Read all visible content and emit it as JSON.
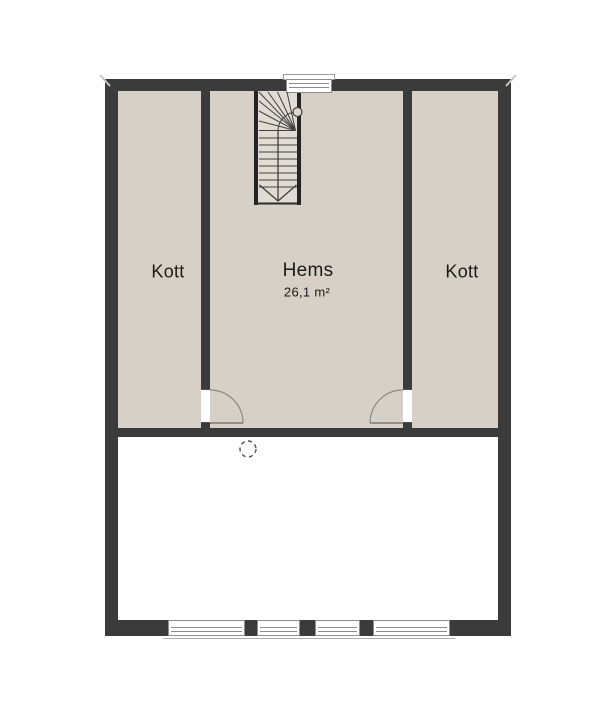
{
  "rooms": {
    "kott_left": {
      "label": "Kott"
    },
    "hems": {
      "label": "Hems",
      "area": "26,1 m²"
    },
    "kott_right": {
      "label": "Kott"
    }
  },
  "symbols": {
    "staircase": "winder-staircase",
    "stair_direction": "down-arrow",
    "stair_newel": "circle",
    "ceiling_marker": "dashed-circle",
    "doors": [
      "kott-left-door-swing",
      "kott-right-door-swing"
    ],
    "windows": [
      "top-window",
      "bottom-window-1",
      "bottom-window-2",
      "bottom-window-3",
      "bottom-window-4"
    ]
  },
  "colors": {
    "wall": "#3b3b3b",
    "floor": "#d6d0c6",
    "stair": "#e1dcd3",
    "void": "#ffffff"
  }
}
